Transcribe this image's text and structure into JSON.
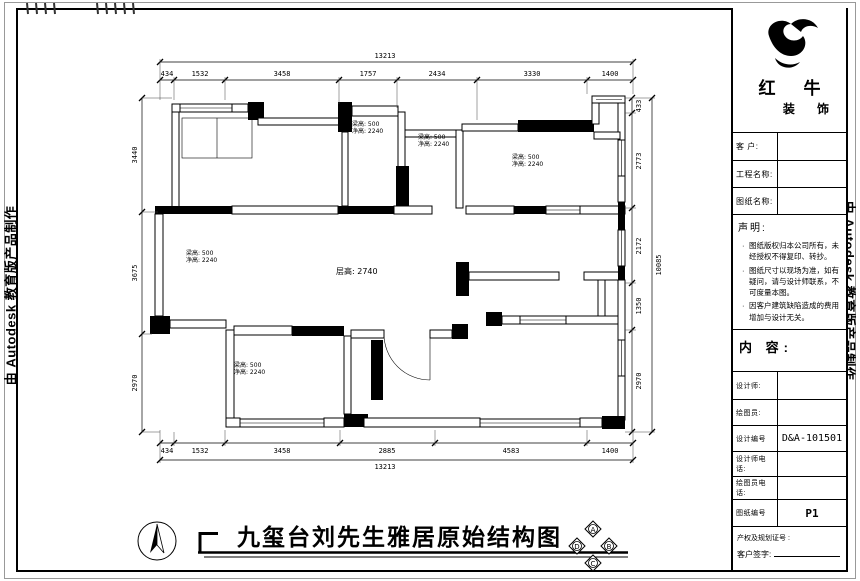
{
  "edge_stamps": {
    "left": "由 Autodesk 教育版产品制作",
    "right": "由 Autodesk 教育版产品制作"
  },
  "title_block": {
    "brand": {
      "name": "红 牛",
      "suffix": "装 饰"
    },
    "fields": [
      {
        "label": "客  户:",
        "value": ""
      },
      {
        "label": "工程名称:",
        "value": ""
      },
      {
        "label": "图纸名称:",
        "value": ""
      }
    ],
    "statement": {
      "heading": "声明:",
      "items": [
        "图纸版权归本公司所有，未经授权不得复印、转抄。",
        "图纸尺寸以现场为准，如有疑问，请与设计师联系，不可度量本图。",
        "因客户建筑缺陷造成的费用增加与设计无关。"
      ]
    },
    "content_label": "内 容:",
    "rows": [
      {
        "label": "设计师:",
        "value": ""
      },
      {
        "label": "绘图员:",
        "value": ""
      },
      {
        "label": "设计编号",
        "value": "D&A-101501"
      },
      {
        "label": "设计师电话:",
        "value": ""
      },
      {
        "label": "绘图员电话:",
        "value": ""
      },
      {
        "label": "图纸编号",
        "value": "P1"
      }
    ],
    "footer": {
      "certificate_label": "产权及规划证号 :",
      "signature_label": "客户签字:"
    }
  },
  "plan": {
    "floor_height_label": "层高: 2740",
    "beam_labels": [
      {
        "line1": "梁高: 500",
        "line2": "净高: 2240"
      },
      {
        "line1": "梁高: 500",
        "line2": "净高: 2240"
      },
      {
        "line1": "梁高: 500",
        "line2": "净高: 2240"
      },
      {
        "line1": "梁高: 500",
        "line2": "净高: 2240"
      },
      {
        "line1": "梁高: 500",
        "line2": "净高: 2240"
      }
    ],
    "dims": {
      "top_total": "13213",
      "top_segments": [
        "434",
        "1532",
        "3458",
        "1757",
        "2434",
        "3330",
        "1400"
      ],
      "bottom_total": "13213",
      "bottom_segments": [
        "434",
        "1532",
        "3458",
        "2885",
        "4583",
        "1400"
      ],
      "left_segments": [
        "3440",
        "3675",
        "2970"
      ],
      "right_segments": [
        "433",
        "2773",
        "2172",
        "1350",
        "2970"
      ],
      "right_total": "10085"
    }
  },
  "footer": {
    "title": "九玺台刘先生雅居原始结构图",
    "markers": [
      "A",
      "B",
      "C",
      "D"
    ]
  }
}
